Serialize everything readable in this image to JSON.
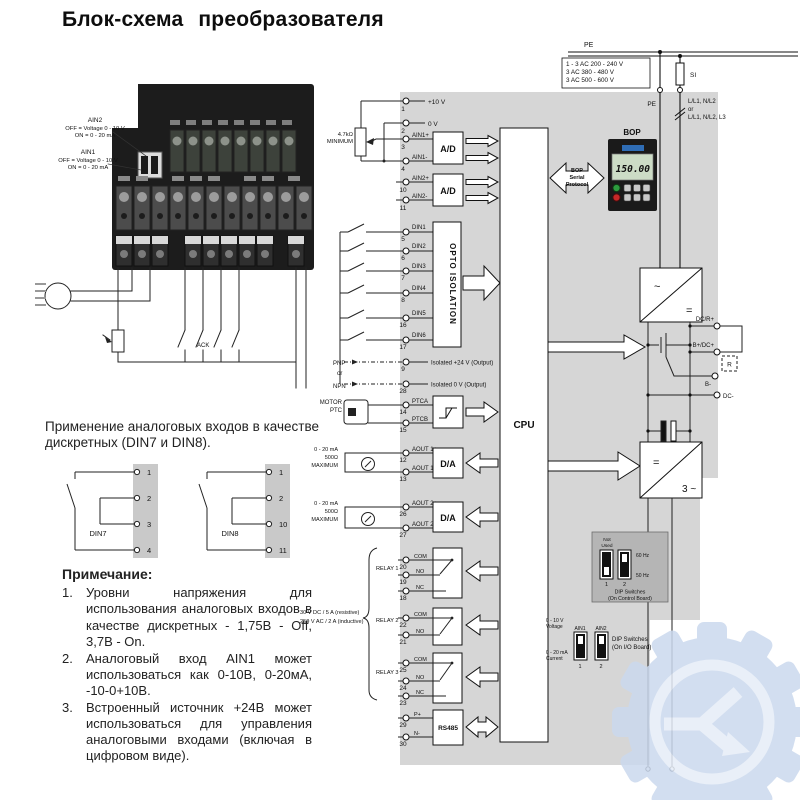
{
  "title": "Блок-схема преобразователя",
  "photo": {
    "ain2": {
      "name": "AIN2",
      "off": "OFF = Voltage 0 - 10 V",
      "on": "ON  = 0 - 20 mA"
    },
    "ain1": {
      "name": "AIN1",
      "off": "OFF = Voltage 0 - 10 V",
      "on": "ON  = 0 - 20 mA"
    },
    "ack": "ACK"
  },
  "usage": {
    "text": "Применение аналоговых входов в качестве дискретных (DIN7 и DIN8).",
    "din7": {
      "label": "DIN7",
      "terminals": [
        "1",
        "2",
        "3",
        "4"
      ]
    },
    "din8": {
      "label": "DIN8",
      "terminals": [
        "1",
        "2",
        "10",
        "11"
      ]
    }
  },
  "notes": {
    "heading": "Примечание:",
    "items": [
      {
        "num": "1.",
        "text": "Уровни напряжения для использования аналоговых входов в качестве дискретных - 1,75В - Off, 3,7В - On."
      },
      {
        "num": "2.",
        "text": "Аналоговый вход AIN1 может использоваться как 0-10В, 0-20мА, -10-0+10В."
      },
      {
        "num": "3.",
        "text": "Встроенный источник +24В может использоваться для управления аналоговыми входами (включая в цифровом виде)."
      }
    ]
  },
  "mains": {
    "pe_top": "PE",
    "voltages": [
      "1 - 3 AC 200 - 240 V",
      "3 AC 380 - 480 V",
      "3 AC 500 - 600 V"
    ],
    "fuse": "SI",
    "pe_drop": "PE",
    "supply": [
      "L/L1, N/L2",
      "or",
      "L/L1, N/L2, L3"
    ]
  },
  "bop": {
    "label": "BOP",
    "display": "150.00",
    "protocol": [
      "BOP",
      "Serial",
      "Protocol"
    ]
  },
  "analog_in": {
    "pot": [
      "4.7kΩ",
      "MINIMUM"
    ],
    "ad_label": "A/D",
    "terminals": [
      {
        "num": "1",
        "label": "+10 V"
      },
      {
        "num": "2",
        "label": "0 V"
      },
      {
        "num": "3",
        "label": "AIN1+"
      },
      {
        "num": "4",
        "label": "AIN1-"
      },
      {
        "num": "10",
        "label": "AIN2+"
      },
      {
        "num": "11",
        "label": "AIN2-"
      }
    ]
  },
  "digital_in": {
    "opto": "OPTO ISOLATION",
    "pnp": "PNP",
    "or": "or",
    "npn": "NPN",
    "terminals": [
      {
        "num": "5",
        "label": "DIN1"
      },
      {
        "num": "6",
        "label": "DIN2"
      },
      {
        "num": "7",
        "label": "DIN3"
      },
      {
        "num": "8",
        "label": "DIN4"
      },
      {
        "num": "16",
        "label": "DIN5"
      },
      {
        "num": "17",
        "label": "DIN6"
      }
    ],
    "iso24": {
      "num": "9",
      "label": "Isolated +24 V (Output)"
    },
    "iso0": {
      "num": "28",
      "label": "Isolated 0 V (Output)"
    }
  },
  "ptc": {
    "motor": [
      "MOTOR",
      "PTC"
    ],
    "terminals": [
      {
        "num": "14",
        "label": "PTCA"
      },
      {
        "num": "15",
        "label": "PTCB"
      }
    ]
  },
  "aout": {
    "max_note": [
      "0 - 20 mA",
      "500Ω",
      "MAXIMUM"
    ],
    "da_label": "D/A",
    "ch1": [
      {
        "num": "12",
        "label": "AOUT 1+"
      },
      {
        "num": "13",
        "label": "AOUT 1-"
      }
    ],
    "ch2": [
      {
        "num": "26",
        "label": "AOUT 2+"
      },
      {
        "num": "27",
        "label": "AOUT 2-"
      }
    ]
  },
  "relays": {
    "spec": [
      "30 V DC / 5 A (resistive)",
      "250 V AC / 2 A (inductive)"
    ],
    "groups": [
      {
        "name": "RELAY 1",
        "contacts": [
          {
            "num": "20",
            "label": "COM"
          },
          {
            "num": "19",
            "label": "NO"
          },
          {
            "num": "18",
            "label": "NC"
          }
        ]
      },
      {
        "name": "RELAY 2",
        "contacts": [
          {
            "num": "22",
            "label": "COM"
          },
          {
            "num": "21",
            "label": "NO"
          }
        ]
      },
      {
        "name": "RELAY 3",
        "contacts": [
          {
            "num": "25",
            "label": "COM"
          },
          {
            "num": "24",
            "label": "NO"
          },
          {
            "num": "23",
            "label": "NC"
          }
        ]
      }
    ]
  },
  "rs485": {
    "block": "RS485",
    "terminals": [
      {
        "num": "29",
        "label": "P+"
      },
      {
        "num": "30",
        "label": "N-"
      }
    ]
  },
  "cpu": "CPU",
  "power": {
    "rectifier": {
      "in": "~",
      "out": "="
    },
    "inverter": {
      "in": "=",
      "out": "3 ~"
    },
    "dc_terminals": {
      "dcr": "DC/R+",
      "bdc": "B+/DC+",
      "r": "R",
      "bminus": "B-",
      "dcminus": "DC-"
    }
  },
  "dip_control": {
    "not_used": [
      "Not",
      "Used"
    ],
    "hz60": "60 Hz",
    "hz50": "50 Hz",
    "sw": [
      "1",
      "2"
    ],
    "caption": [
      "DIP Switches",
      "(On Control Board)"
    ]
  },
  "dip_io": {
    "voltage": [
      "0 - 10 V",
      "Voltage"
    ],
    "current": [
      "0 - 20 mA",
      "Current"
    ],
    "ain": [
      "AIN1",
      "AIN2"
    ],
    "sw": [
      "1",
      "2"
    ],
    "caption": [
      "DIP Switches",
      "(On I/O Board)"
    ]
  }
}
